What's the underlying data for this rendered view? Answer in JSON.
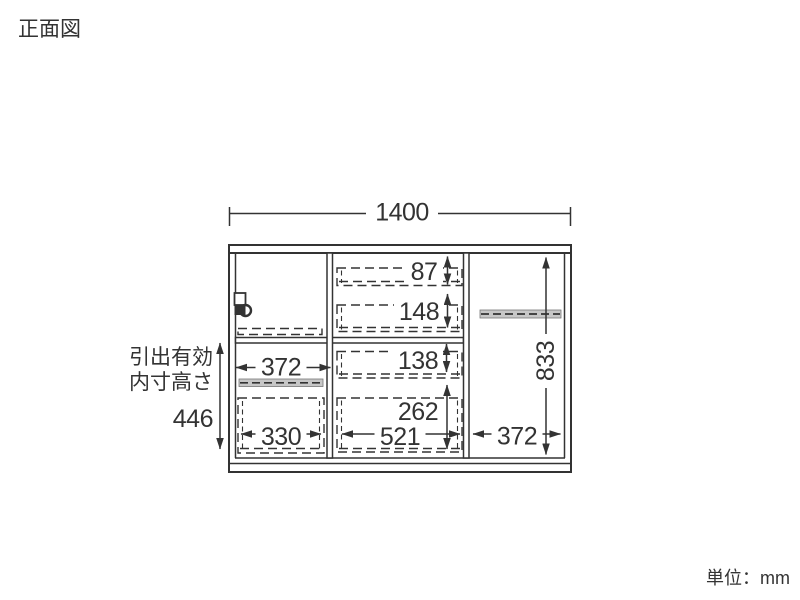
{
  "title": "正面図",
  "unit_label": "単位：mm",
  "drawer_note": {
    "line1": "引出有効",
    "line2": "内寸高さ",
    "value": "446"
  },
  "dims": {
    "total_width": "1400",
    "total_height": "833",
    "top_drawer_height": "87",
    "second_drawer_height": "148",
    "third_drawer_height": "138",
    "bottom_drawer_height": "262",
    "bottom_drawer_width": "521",
    "left_section_width": "372",
    "left_drawer_width": "330",
    "right_section_width": "372"
  },
  "colors": {
    "line": "#333333",
    "text": "#333333",
    "shelf_fill": "#c7c7c7",
    "background": "#ffffff"
  }
}
